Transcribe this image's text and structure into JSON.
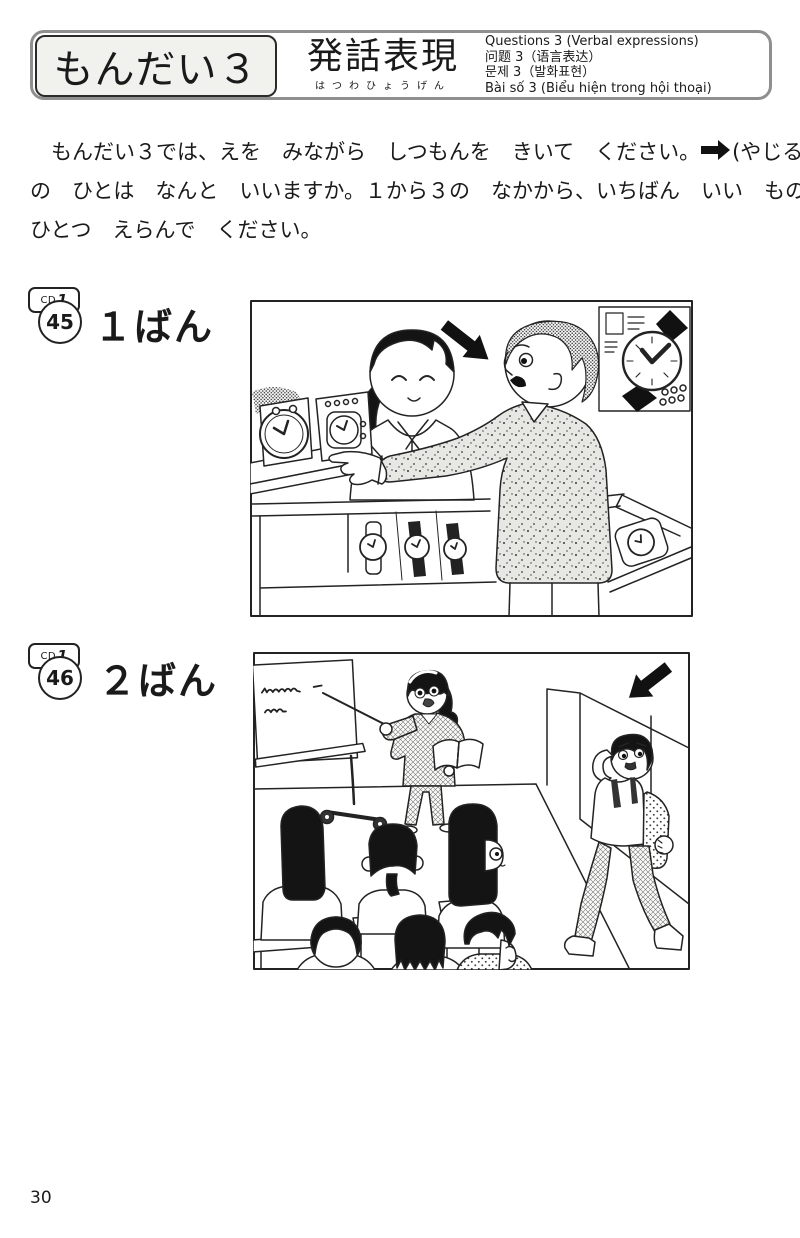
{
  "header": {
    "title": "もんだい３",
    "subtitle": "発話表現",
    "subtitle_furigana": "はつわひょうげん",
    "translations": [
      "Questions 3 (Verbal expressions)",
      "问题 3（语言表达）",
      "문제 3（발화표현）",
      "Bài số 3 (Biểu hiện trong hội thoại)"
    ]
  },
  "instructions": {
    "line1_before_arrow": "　もんだい３では、えを　みながら　しつもんを　きいて　ください。",
    "line1_after_arrow": "(やじるし)",
    "line2": "の　ひとは　なんと　いいますか。１から３の　なかから、いちばん　いい　ものを",
    "line3": "ひとつ　えらんで　ください。"
  },
  "questions": [
    {
      "cd_label": "CD",
      "cd_disc": "1",
      "track_number": "45",
      "label": "１ばん",
      "scene": "watch shop: clerk behind counter, customer (marked by arrow) pointing at watch display"
    },
    {
      "cd_label": "CD",
      "cd_disc": "1",
      "track_number": "46",
      "label": "２ばん",
      "scene": "classroom: teacher pointing at whiteboard, seated students, boy with backpack (marked by arrow) arriving at door"
    }
  ],
  "page": {
    "number": "30"
  },
  "colors": {
    "ink": "#1a1a1a",
    "header_border": "#8f8f8f",
    "paper": "#ffffff"
  }
}
